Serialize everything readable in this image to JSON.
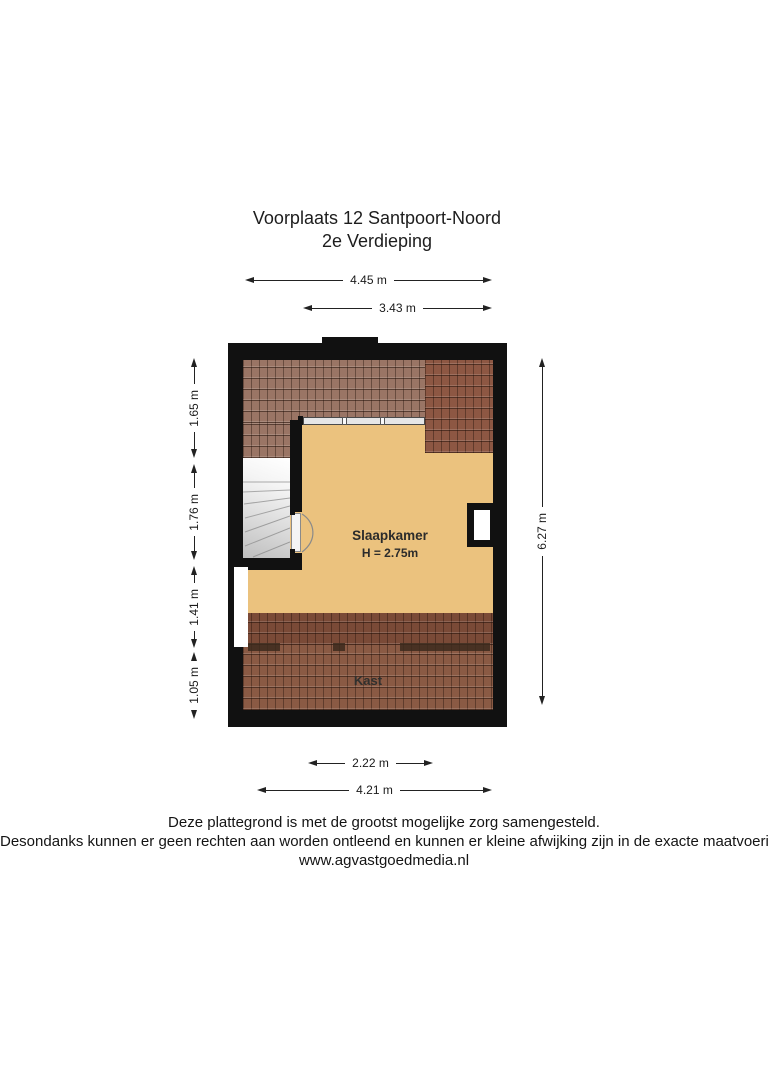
{
  "title": {
    "line1": "Voorplaats 12 Santpoort-Noord",
    "line2": "2e Verdieping"
  },
  "plan": {
    "rooms": [
      {
        "name": "Slaapkamer",
        "ceiling": "H = 2.75m"
      },
      {
        "name": "Kast"
      }
    ]
  },
  "dimensions": {
    "top_outer": "4.45 m",
    "top_inner": "3.43 m",
    "left": [
      "1.65 m",
      "1.76 m",
      "1.41 m",
      "1.05 m"
    ],
    "right": "6.27 m",
    "bottom_inner": "2.22 m",
    "bottom_outer": "4.21 m"
  },
  "footer": {
    "line1": "Deze plattegrond is met de grootst mogelijke zorg samengesteld.",
    "line2": "Desondanks kunnen er geen rechten aan worden ontleend en kunnen er kleine afwijking zijn in de exacte maatvoering.",
    "line3": "www.agvastgoedmedia.nl"
  },
  "colors": {
    "wall": "#111111",
    "floor": "#ebc27e",
    "roof_top": "#9a7565",
    "roof_top_right": "#8d5743",
    "roof_band_dark": "#7a4a37",
    "roof_kast": "#8a5a44",
    "stairs": "#e9e9e9"
  }
}
